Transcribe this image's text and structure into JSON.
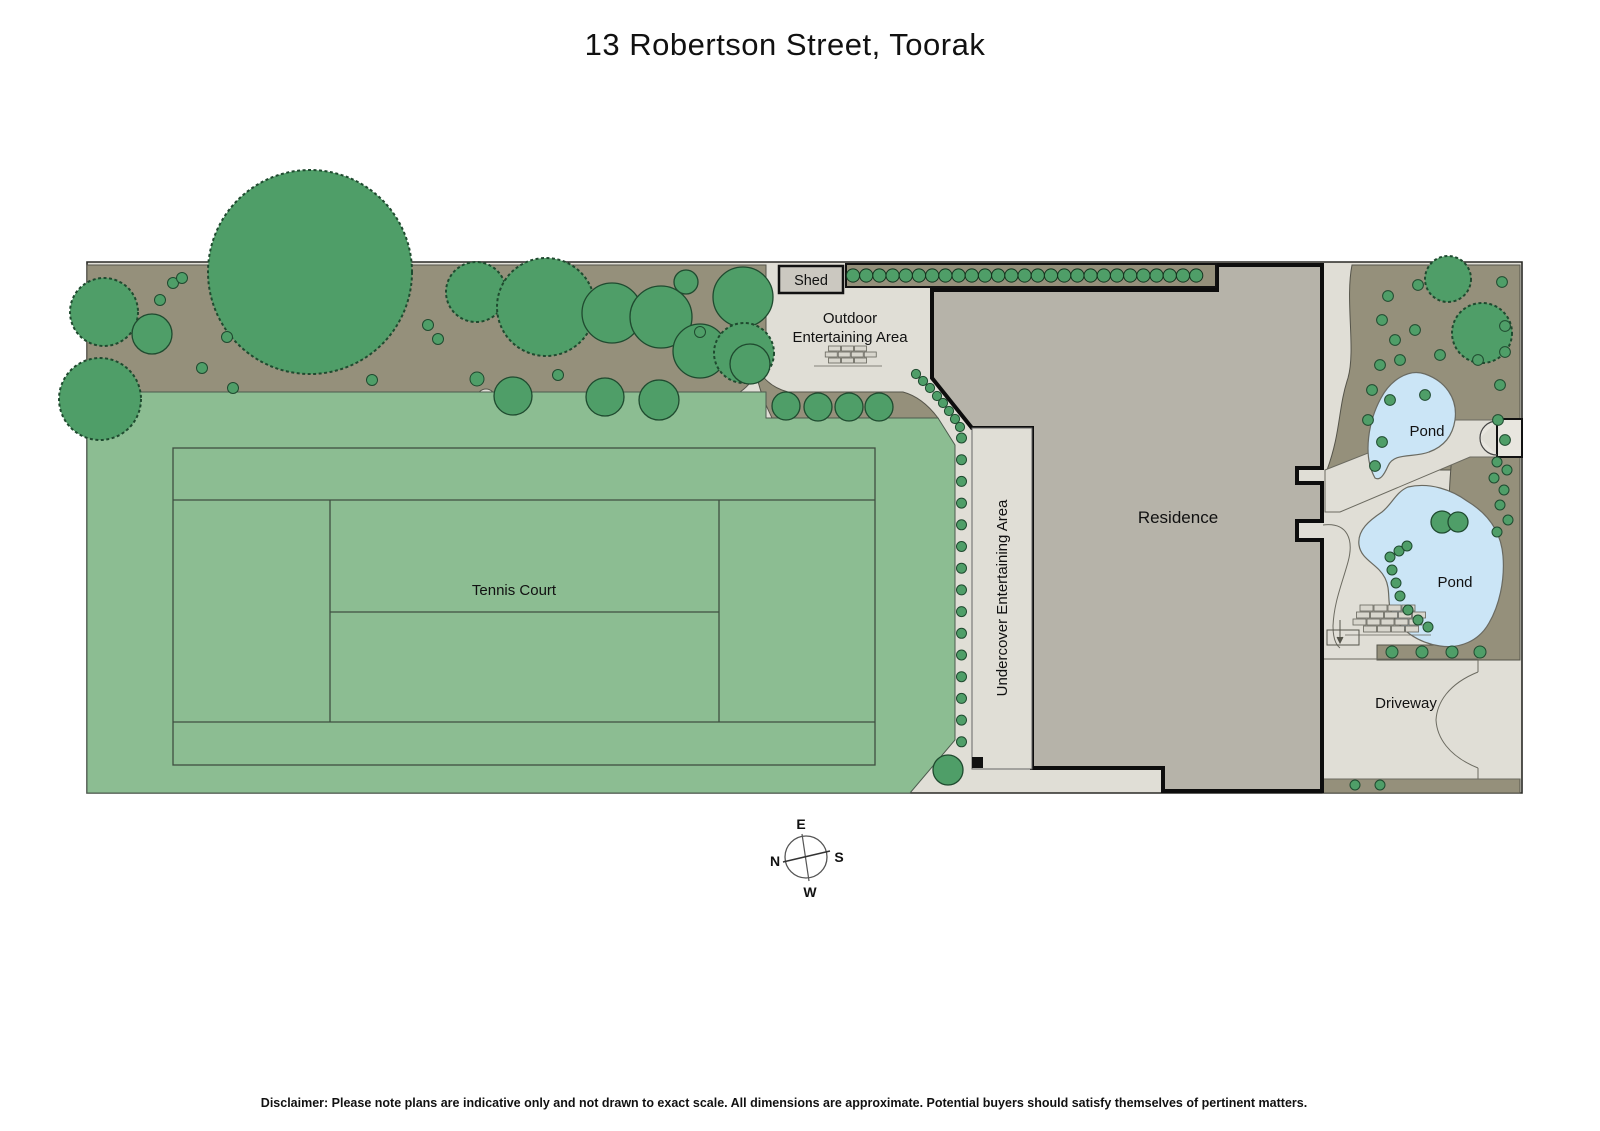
{
  "title": "13 Robertson Street, Toorak",
  "labels": {
    "shed": "Shed",
    "outdoor_line1": "Outdoor",
    "outdoor_line2": "Entertaining Area",
    "undercover": "Undercover Entertaining Area",
    "residence": "Residence",
    "tennis_court": "Tennis Court",
    "pond_upper": "Pond",
    "pond_lower": "Pond",
    "driveway": "Driveway"
  },
  "compass": {
    "top": "E",
    "right": "S",
    "bottom": "W",
    "left": "N"
  },
  "disclaimer": "Disclaimer: Please note plans are indicative only and not drawn to exact scale. All dimensions are approximate. Potential buyers should satisfy themselves of pertinent matters.",
  "colors": {
    "lawn": "#8cbd92",
    "garden_bed": "#95907b",
    "tree": "#4f9e68",
    "walkway": "#e0ded6",
    "residence": "#b6b3a9",
    "pond": "#cbe5f6",
    "shed": "#cbc8c0",
    "outline": "#1a1a1a"
  }
}
